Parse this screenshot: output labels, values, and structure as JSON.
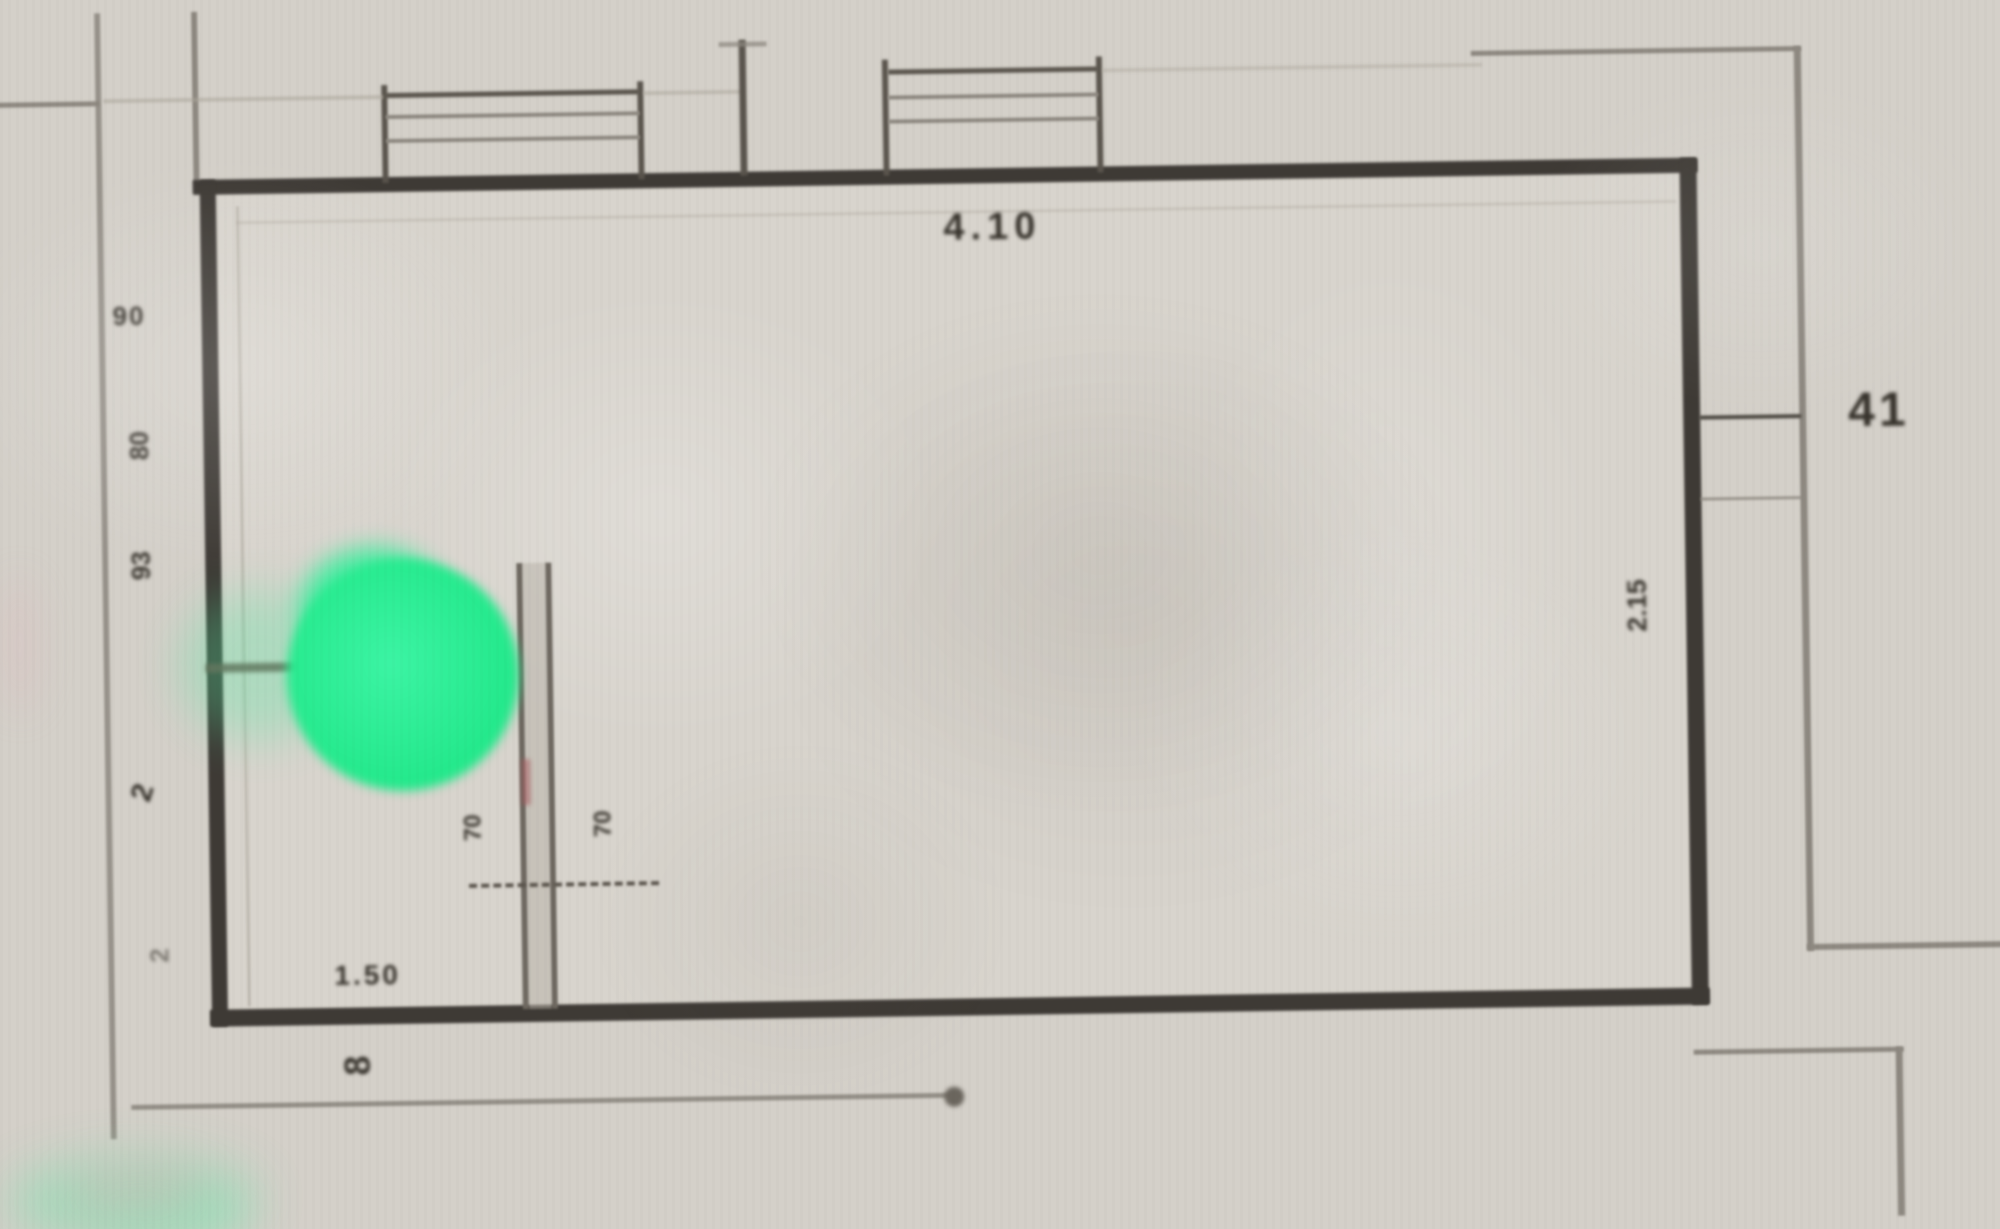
{
  "title": "Scanned floor plan detail with location marker",
  "colors": {
    "paper": "#d4d0c9",
    "wall_dark": "#3e3a35",
    "line_grey": "#8d8880",
    "marker_green": "#25ec8e",
    "accent_red": "#a85a5f"
  },
  "room": {
    "dimensions": {
      "top_width": "4.10",
      "right_offset": "41",
      "right_height": "2.15",
      "bottom_left_width": "1.50",
      "bottom_left_tick": "8",
      "left_chain": [
        "90",
        "80",
        "93",
        "2",
        "2"
      ],
      "door_opening_left": "70",
      "door_opening_right": "70"
    }
  }
}
